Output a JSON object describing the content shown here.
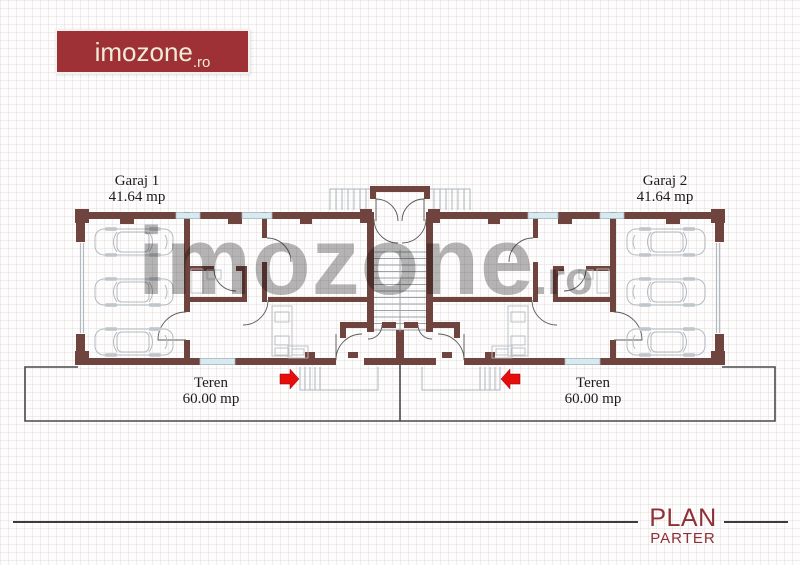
{
  "brand": {
    "logo_text": "imozone",
    "logo_tld": ".ro"
  },
  "watermark": {
    "text": "imozone",
    "tld": ".ro"
  },
  "plan_labels": {
    "garage_left": {
      "name": "Garaj 1",
      "area": "41.64 mp"
    },
    "garage_right": {
      "name": "Garaj 2",
      "area": "41.64 mp"
    },
    "plot_left": {
      "name": "Teren",
      "area": "60.00 mp"
    },
    "plot_right": {
      "name": "Teren",
      "area": "60.00 mp"
    }
  },
  "title_block": {
    "title": "PLAN",
    "subtitle": "PARTER"
  },
  "colors": {
    "brand_red": "#9e3136",
    "wall_brown": "#6f433e",
    "window_blue": "#d9e9f0",
    "arrow_red": "#e60d0d",
    "title_red": "#8e3036",
    "watermark_gray": "#7a7a7a"
  }
}
